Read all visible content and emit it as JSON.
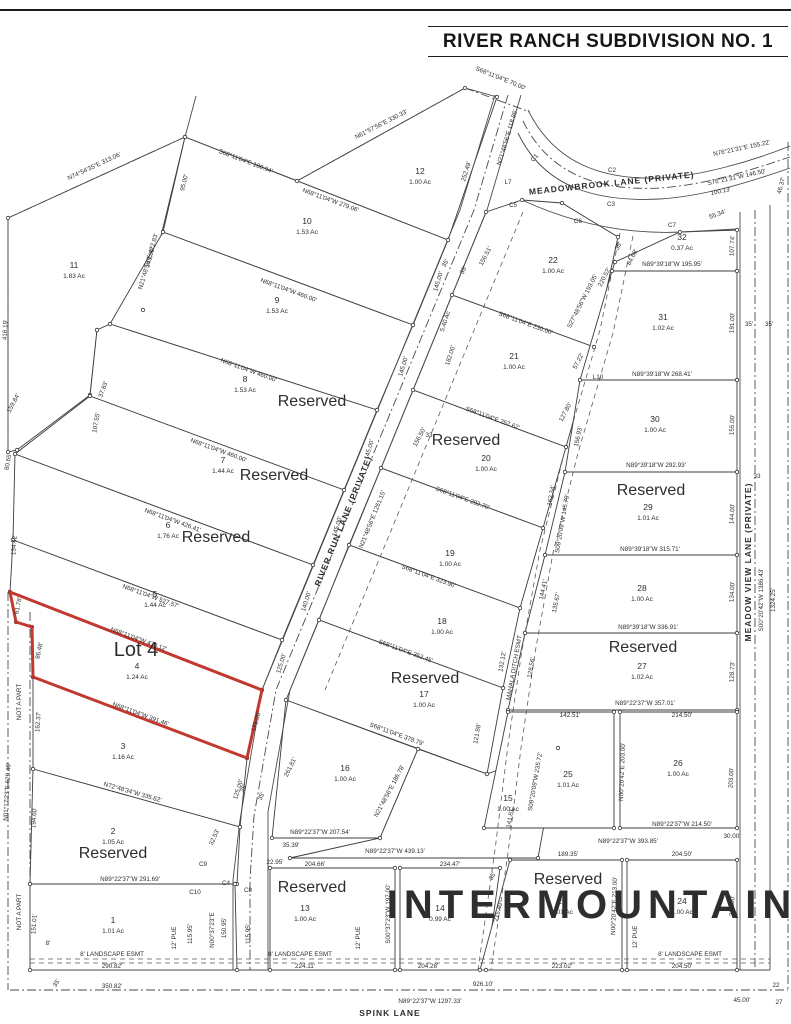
{
  "title": "RIVER RANCH SUBDIVISION NO. 1",
  "watermark": "INTERMOUNTAIN",
  "colors": {
    "highlight_red": "#c2382e",
    "reserved_blue": "#1a607f",
    "line": "#3c3c3c",
    "watermark": "rgba(125,125,125,0.22)"
  },
  "highlight": {
    "label": "Lot 4",
    "x": 136,
    "y": 656,
    "lot": "4"
  },
  "streets": [
    {
      "name": "MEADOWBROOK  LANE  (PRIVATE)",
      "x": 612,
      "y": 186,
      "r": -6,
      "fs": 8.5
    },
    {
      "name": "RIVER RUN LANE (PRIVATE)",
      "x": 346,
      "y": 522,
      "r": -68,
      "fs": 8.5
    },
    {
      "name": "MEADOW VIEW LANE (PRIVATE)",
      "x": 751,
      "y": 562,
      "r": -90,
      "fs": 8.5
    },
    {
      "name": "SPINK LANE",
      "x": 390,
      "y": 1016,
      "r": 0,
      "fs": 8.5
    }
  ],
  "lots": [
    {
      "num": "11",
      "ac": "1.83 Ac",
      "pts": "8,218 185,137 143,310 97,330 90,395 17,450 8,452",
      "lx": 74,
      "ly": 268
    },
    {
      "num": "12",
      "ac": "1.00 Ac",
      "pts": "185,137 297,181 465,88 497,97 448,240",
      "lx": 420,
      "ly": 174
    },
    {
      "num": "10",
      "ac": "1.53 Ac",
      "pts": "185,137 448,240 413,325 163,232",
      "lx": 307,
      "ly": 224
    },
    {
      "num": "9",
      "ac": "1.53 Ac",
      "pts": "163,232 413,325 377,410 110,324",
      "lx": 277,
      "ly": 303
    },
    {
      "num": "8",
      "ac": "1.53 Ac",
      "pts": "110,324 377,410 344,490 90,396 97,330",
      "lx": 245,
      "ly": 382,
      "res": true,
      "rx": 312,
      "ry": 406
    },
    {
      "num": "7",
      "ac": "1.44 Ac",
      "pts": "90,396 344,490 313,565 15,454",
      "lx": 223,
      "ly": 463,
      "res": true,
      "rx": 274,
      "ry": 480
    },
    {
      "num": "6",
      "ac": "1.76 Ac",
      "pts": "15,454 313,565 282,640 13,540",
      "lx": 168,
      "ly": 528,
      "res": true,
      "rx": 216,
      "ry": 542
    },
    {
      "num": "5",
      "ac": "1.44 Ac",
      "pts": "13,540 282,640 262,690 10,592",
      "lx": 155,
      "ly": 597
    },
    {
      "num": "4",
      "ac": "1.24 Ac",
      "pts": "10,592 262,690 247,758 33,677 32,627 16,622",
      "lx": 137,
      "ly": 669,
      "hl": true
    },
    {
      "num": "3",
      "ac": "1.16 Ac",
      "pts": "33,677 247,758 240,827 33,769",
      "lx": 123,
      "ly": 749
    },
    {
      "num": "2",
      "ac": "1.05 Ac",
      "pts": "33,769 240,827 237,884 30,884",
      "lx": 113,
      "ly": 834,
      "res": true,
      "rx": 113,
      "ry": 858
    },
    {
      "num": "1",
      "ac": "1.01 Ac",
      "pts": "30,884 235,884 237,970 30,970",
      "lx": 113,
      "ly": 923
    },
    {
      "num": "22",
      "ac": "1.00 Ac",
      "pts": "452,295 486,212 522,200 562,203 618,237 594,347",
      "lx": 553,
      "ly": 263
    },
    {
      "num": "21",
      "ac": "1.00 Ac",
      "pts": "413,390 452,295 594,347 566,447",
      "lx": 514,
      "ly": 359
    },
    {
      "num": "20",
      "ac": "1.00 Ac",
      "pts": "381,468 413,390 566,447 543,528",
      "lx": 486,
      "ly": 461,
      "res": true,
      "rx": 466,
      "ry": 445
    },
    {
      "num": "19",
      "ac": "1.00 Ac",
      "pts": "349,545 381,468 543,528 520,608",
      "lx": 450,
      "ly": 556
    },
    {
      "num": "18",
      "ac": "1.00 Ac",
      "pts": "319,620 349,545 520,608 503,688",
      "lx": 442,
      "ly": 624
    },
    {
      "num": "17",
      "ac": "1.00 Ac",
      "pts": "286,700 319,620 503,688 487,774",
      "lx": 424,
      "ly": 697,
      "res": true,
      "rx": 425,
      "ry": 683
    },
    {
      "num": "16",
      "ac": "1.00 Ac",
      "pts": "286,700 418,749 380,838 272,838",
      "lx": 345,
      "ly": 771
    },
    {
      "num": "15",
      "ac": "1.00 Ac",
      "pts": "418,749 487,774 558,748 538,858 290,858 380,838",
      "lx": 508,
      "ly": 801
    },
    {
      "num": "13",
      "ac": "1.00 Ac",
      "pts": "270,868 395,868 395,970 270,970",
      "lx": 305,
      "ly": 911,
      "res": true,
      "rx": 312,
      "ry": 892
    },
    {
      "num": "14",
      "ac": "0.99 Ac",
      "pts": "400,868 500,868 486,970 400,970",
      "lx": 440,
      "ly": 911
    },
    {
      "num": "23",
      "ac": "1.01 Ac",
      "pts": "510,860 622,860 622,970 480,970",
      "lx": 562,
      "ly": 904,
      "res": true,
      "rx": 568,
      "ry": 884
    },
    {
      "num": "24",
      "ac": "1.00 Ac",
      "pts": "627,860 737,860 737,970 627,970",
      "lx": 682,
      "ly": 904
    },
    {
      "num": "32",
      "ac": "0.37 Ac",
      "pts": "612,271 737,271 737,230 680,232 615,262",
      "lx": 682,
      "ly": 240
    },
    {
      "num": "31",
      "ac": "1.02 Ac",
      "pts": "612,271 737,271 737,380 580,380",
      "lx": 663,
      "ly": 320
    },
    {
      "num": "30",
      "ac": "1.00 Ac",
      "pts": "580,380 737,380 737,472 565,472",
      "lx": 655,
      "ly": 422
    },
    {
      "num": "29",
      "ac": "1.01 Ac",
      "pts": "565,472 737,472 737,555 545,555",
      "lx": 648,
      "ly": 510,
      "res": true,
      "rx": 651,
      "ry": 495
    },
    {
      "num": "28",
      "ac": "1.00 Ac",
      "pts": "545,555 737,555 737,633 525,633",
      "lx": 642,
      "ly": 591
    },
    {
      "num": "27",
      "ac": "1.02 Ac",
      "pts": "525,633 737,633 737,710 508,710",
      "lx": 642,
      "ly": 669,
      "res": true,
      "rx": 643,
      "ry": 652
    },
    {
      "num": "26",
      "ac": "1.00 Ac",
      "pts": "620,712 737,712 737,828 620,828",
      "lx": 678,
      "ly": 766
    },
    {
      "num": "25",
      "ac": "1.01 Ac",
      "pts": "508,712 614,712 614,828 484,828",
      "lx": 568,
      "ly": 777
    }
  ],
  "reserved_label": "Reserved",
  "bearings": [
    {
      "t": "N74°54'35\"E  313.06'",
      "x": 95,
      "y": 168,
      "r": -25
    },
    {
      "t": "S68°11'04\"E  180.94'",
      "x": 245,
      "y": 163,
      "r": 21
    },
    {
      "t": "N61°57'56\"E  330.33'",
      "x": 382,
      "y": 126,
      "r": -27
    },
    {
      "t": "S68°11'04\"E  70.00'",
      "x": 500,
      "y": 80,
      "r": 22
    },
    {
      "t": "N21°48'56\"E 118.86'",
      "x": 509,
      "y": 138,
      "r": -73
    },
    {
      "t": "252.49'",
      "x": 468,
      "y": 172,
      "r": -73
    },
    {
      "t": "95.00'",
      "x": 186,
      "y": 183,
      "r": -76
    },
    {
      "t": "N21°48'56\"E  422.83'",
      "x": 150,
      "y": 262,
      "r": -74
    },
    {
      "t": "145.00'",
      "x": 152,
      "y": 258,
      "r": -74
    },
    {
      "t": "416.19'",
      "x": 7,
      "y": 330,
      "r": -88
    },
    {
      "t": "107.55'",
      "x": 98,
      "y": 423,
      "r": -80
    },
    {
      "t": "37.83'",
      "x": 105,
      "y": 390,
      "r": -70
    },
    {
      "t": "159.84'",
      "x": 15,
      "y": 404,
      "r": -62
    },
    {
      "t": "80.65'",
      "x": 10,
      "y": 462,
      "r": -80
    },
    {
      "t": "134.42'",
      "x": 16,
      "y": 545,
      "r": -86
    },
    {
      "t": "61.78'",
      "x": 20,
      "y": 606,
      "r": -78
    },
    {
      "t": "86.48'",
      "x": 41,
      "y": 651,
      "r": -78
    },
    {
      "t": "162.37'",
      "x": 40,
      "y": 722,
      "r": -86
    },
    {
      "t": "NOT A PART",
      "x": 21,
      "y": 702,
      "r": -90
    },
    {
      "t": "NOT A PART",
      "x": 21,
      "y": 912,
      "r": -90
    },
    {
      "t": "N01°17'23\"E  629.46'",
      "x": 9,
      "y": 792,
      "r": -87
    },
    {
      "t": "194.60'",
      "x": 36,
      "y": 818,
      "r": -86
    },
    {
      "t": "151.01'",
      "x": 36,
      "y": 924,
      "r": -86
    },
    {
      "t": "N68°11'04\"W  279.06'",
      "x": 330,
      "y": 202,
      "r": 20
    },
    {
      "t": "N68°11'04\"W  460.00'",
      "x": 288,
      "y": 292,
      "r": 20
    },
    {
      "t": "N68°11'04\"W  460.00'",
      "x": 248,
      "y": 372,
      "r": 20
    },
    {
      "t": "N68°11'04\"W  460.00'",
      "x": 218,
      "y": 452,
      "r": 20
    },
    {
      "t": "N68°11'04\"W  426.41'",
      "x": 172,
      "y": 522,
      "r": 20
    },
    {
      "t": "N68°11'04\"W  527.57'",
      "x": 150,
      "y": 598,
      "r": 20
    },
    {
      "t": "N68°11'04\"W  478.12'",
      "x": 138,
      "y": 641,
      "r": 20
    },
    {
      "t": "N68°11'04\"W  391.46'",
      "x": 140,
      "y": 716,
      "r": 20
    },
    {
      "t": "N72°48'34\"W  335.62'",
      "x": 132,
      "y": 794,
      "r": 16
    },
    {
      "t": "N89°22'37\"W  291.69'",
      "x": 130,
      "y": 881,
      "r": 0
    },
    {
      "t": "145.00'",
      "x": 440,
      "y": 282,
      "r": -73
    },
    {
      "t": "145.00'",
      "x": 405,
      "y": 367,
      "r": -73
    },
    {
      "t": "145.00'",
      "x": 371,
      "y": 450,
      "r": -73
    },
    {
      "t": "145.00'",
      "x": 339,
      "y": 527,
      "r": -73
    },
    {
      "t": "140.00'",
      "x": 308,
      "y": 602,
      "r": -73
    },
    {
      "t": "125.00'",
      "x": 283,
      "y": 664,
      "r": -73
    },
    {
      "t": "175.00'",
      "x": 258,
      "y": 722,
      "r": -73
    },
    {
      "t": "125.00'",
      "x": 240,
      "y": 790,
      "r": -73
    },
    {
      "t": "32.53'",
      "x": 216,
      "y": 838,
      "r": -66
    },
    {
      "t": "35'",
      "x": 245,
      "y": 789,
      "r": -64
    },
    {
      "t": "35'",
      "x": 263,
      "y": 797,
      "r": -64
    },
    {
      "t": "C9",
      "x": 203,
      "y": 866,
      "r": 0
    },
    {
      "t": "C10",
      "x": 195,
      "y": 894,
      "r": 0
    },
    {
      "t": "C4",
      "x": 226,
      "y": 885,
      "r": 0
    },
    {
      "t": "C8",
      "x": 248,
      "y": 892,
      "r": 0
    },
    {
      "t": "N00°37'23\"E",
      "x": 214,
      "y": 930,
      "r": -90
    },
    {
      "t": "150.95'",
      "x": 226,
      "y": 928,
      "r": -90
    },
    {
      "t": "12' PUE",
      "x": 176,
      "y": 938,
      "r": -90
    },
    {
      "t": "115.95'",
      "x": 192,
      "y": 934,
      "r": -90
    },
    {
      "t": "8'",
      "x": 48,
      "y": 945,
      "r": 0
    },
    {
      "t": "8' LANDSCAPE ESMT",
      "x": 112,
      "y": 956,
      "r": 0
    },
    {
      "t": "290.82'",
      "x": 112,
      "y": 968,
      "r": 0
    },
    {
      "t": "35'",
      "x": 58,
      "y": 984,
      "r": -60
    },
    {
      "t": "350.82'",
      "x": 112,
      "y": 988,
      "r": 0
    },
    {
      "t": "926.10'",
      "x": 483,
      "y": 986,
      "r": 0
    },
    {
      "t": "N89°22'37\"W  1297.33'",
      "x": 430,
      "y": 1003,
      "r": 0
    },
    {
      "t": "45.00'",
      "x": 742,
      "y": 1002,
      "r": 0
    },
    {
      "t": "22",
      "x": 776,
      "y": 987,
      "r": 0
    },
    {
      "t": "27",
      "x": 779,
      "y": 1004,
      "r": 0
    },
    {
      "t": "S68°11'04\"E  230.00'",
      "x": 525,
      "y": 325,
      "r": 20
    },
    {
      "t": "S68°11'04\"E  257.62'",
      "x": 492,
      "y": 420,
      "r": 20
    },
    {
      "t": "S68°11'04\"E  292.70'",
      "x": 462,
      "y": 500,
      "r": 20
    },
    {
      "t": "S68°11'04\"E  323.90'",
      "x": 428,
      "y": 578,
      "r": 20
    },
    {
      "t": "S68°11'04\"E  352.45'",
      "x": 405,
      "y": 653,
      "r": 20
    },
    {
      "t": "S68°11'04\"E  378.79'",
      "x": 396,
      "y": 736,
      "r": 20
    },
    {
      "t": "N21°48'56\"E  186.78'",
      "x": 391,
      "y": 792,
      "r": -62
    },
    {
      "t": "N89°22'37\"W  207.54'",
      "x": 320,
      "y": 834,
      "r": 0
    },
    {
      "t": "N89°22'37\"W  439.13'",
      "x": 395,
      "y": 853,
      "r": 0
    },
    {
      "t": "204.66'",
      "x": 315,
      "y": 866,
      "r": 0
    },
    {
      "t": "234.47'",
      "x": 450,
      "y": 866,
      "r": 0
    },
    {
      "t": "35.39'",
      "x": 291,
      "y": 847,
      "r": 0
    },
    {
      "t": "22.95'",
      "x": 275,
      "y": 864,
      "r": 0
    },
    {
      "t": "S00°37'23\"W  197.00'",
      "x": 390,
      "y": 914,
      "r": -90
    },
    {
      "t": "12' PUE",
      "x": 360,
      "y": 938,
      "r": -90
    },
    {
      "t": "115.95'",
      "x": 250,
      "y": 934,
      "r": -90
    },
    {
      "t": "12' PUE",
      "x": 637,
      "y": 937,
      "r": -90
    },
    {
      "t": "8' LANDSCAPE ESMT",
      "x": 300,
      "y": 956,
      "r": 0
    },
    {
      "t": "8' LANDSCAPE ESMT",
      "x": 690,
      "y": 956,
      "r": 0
    },
    {
      "t": "224.11'",
      "x": 305,
      "y": 968,
      "r": 0
    },
    {
      "t": "204.28'",
      "x": 428,
      "y": 968,
      "r": 0
    },
    {
      "t": "223.02'",
      "x": 562,
      "y": 968,
      "r": 0
    },
    {
      "t": "204.50'",
      "x": 682,
      "y": 968,
      "r": 0
    },
    {
      "t": "261.81'",
      "x": 292,
      "y": 768,
      "r": -64
    },
    {
      "t": "5.40 Ac",
      "x": 447,
      "y": 322,
      "r": -72
    },
    {
      "t": "182.00'",
      "x": 452,
      "y": 356,
      "r": -72
    },
    {
      "t": "N21°48'56\"E  1261.15'",
      "x": 374,
      "y": 520,
      "r": -68
    },
    {
      "t": "35'",
      "x": 447,
      "y": 264,
      "r": -62
    },
    {
      "t": "35'",
      "x": 465,
      "y": 271,
      "r": -62
    },
    {
      "t": "35'",
      "x": 620,
      "y": 247,
      "r": -62
    },
    {
      "t": "33",
      "x": 429,
      "y": 437,
      "r": 0
    },
    {
      "t": "156.51'",
      "x": 487,
      "y": 257,
      "r": -62
    },
    {
      "t": "S27°48'56\"W  193.05'",
      "x": 584,
      "y": 302,
      "r": -63
    },
    {
      "t": "220.52'",
      "x": 606,
      "y": 278,
      "r": -63
    },
    {
      "t": "57.22'",
      "x": 580,
      "y": 362,
      "r": -63
    },
    {
      "t": "L10",
      "x": 598,
      "y": 379,
      "r": 0
    },
    {
      "t": "156.50'",
      "x": 421,
      "y": 438,
      "r": -62
    },
    {
      "t": "127.80'",
      "x": 567,
      "y": 413,
      "r": -62
    },
    {
      "t": "156.93'",
      "x": 580,
      "y": 437,
      "r": -78
    },
    {
      "t": "162.34'",
      "x": 553,
      "y": 496,
      "r": -80
    },
    {
      "t": "S09°20'09\"W 145.79'",
      "x": 564,
      "y": 524,
      "r": -80
    },
    {
      "t": "144.41'",
      "x": 545,
      "y": 590,
      "r": -78
    },
    {
      "t": "135.67'",
      "x": 558,
      "y": 603,
      "r": -78
    },
    {
      "t": "MAHALA  DITCH  ESMT",
      "x": 516,
      "y": 668,
      "r": -80
    },
    {
      "t": "132.12'",
      "x": 504,
      "y": 662,
      "r": -80
    },
    {
      "t": "128.56'",
      "x": 533,
      "y": 668,
      "r": -80
    },
    {
      "t": "121.88'",
      "x": 479,
      "y": 734,
      "r": -80
    },
    {
      "t": "S09°20'09\"W 235.72'",
      "x": 537,
      "y": 782,
      "r": -80
    },
    {
      "t": "141.81'",
      "x": 512,
      "y": 818,
      "r": -80
    },
    {
      "t": "35'",
      "x": 494,
      "y": 877,
      "r": -62
    },
    {
      "t": "215.49'",
      "x": 500,
      "y": 912,
      "r": -75
    },
    {
      "t": "142.51'",
      "x": 570,
      "y": 717,
      "r": 0
    },
    {
      "t": "214.50'",
      "x": 682,
      "y": 717,
      "r": 0
    },
    {
      "t": "N89°39'18\"W  195.95'",
      "x": 672,
      "y": 266,
      "r": 0
    },
    {
      "t": "N89°39'18\"W  268.41'",
      "x": 662,
      "y": 376,
      "r": 0
    },
    {
      "t": "N89°39'18\"W  292.93'",
      "x": 656,
      "y": 467,
      "r": 0
    },
    {
      "t": "N89°39'18\"W  315.71'",
      "x": 650,
      "y": 551,
      "r": 0
    },
    {
      "t": "N89°39'18\"W  336.91'",
      "x": 648,
      "y": 629,
      "r": 0
    },
    {
      "t": "N89°22'37\"W  357.01'",
      "x": 645,
      "y": 705,
      "r": 0
    },
    {
      "t": "N89°22'37\"W  214.50'",
      "x": 682,
      "y": 826,
      "r": 0
    },
    {
      "t": "N89°22'37\"W  393.85'",
      "x": 628,
      "y": 843,
      "r": 0
    },
    {
      "t": "30.00'",
      "x": 732,
      "y": 838,
      "r": 0
    },
    {
      "t": "189.35'",
      "x": 568,
      "y": 856,
      "r": 0
    },
    {
      "t": "204.50'",
      "x": 682,
      "y": 856,
      "r": 0
    },
    {
      "t": "107.74'",
      "x": 734,
      "y": 246,
      "r": -87
    },
    {
      "t": "191.00'",
      "x": 734,
      "y": 323,
      "r": -87
    },
    {
      "t": "155.00'",
      "x": 734,
      "y": 425,
      "r": -87
    },
    {
      "t": "144.00'",
      "x": 734,
      "y": 514,
      "r": -87
    },
    {
      "t": "134.00'",
      "x": 734,
      "y": 592,
      "r": -87
    },
    {
      "t": "128.73'",
      "x": 734,
      "y": 672,
      "r": -87
    },
    {
      "t": "203.00'",
      "x": 733,
      "y": 778,
      "r": -87
    },
    {
      "t": "213.00'",
      "x": 734,
      "y": 906,
      "r": -87
    },
    {
      "t": "N00°20'42\"E  203.00'",
      "x": 624,
      "y": 772,
      "r": -88
    },
    {
      "t": "N00°20'42\"E  213.00'",
      "x": 616,
      "y": 906,
      "r": -88
    },
    {
      "t": "84.68'",
      "x": 634,
      "y": 258,
      "r": -63
    },
    {
      "t": "55.34'",
      "x": 718,
      "y": 216,
      "r": -20
    },
    {
      "t": "35'",
      "x": 749,
      "y": 326,
      "r": 0
    },
    {
      "t": "35'",
      "x": 769,
      "y": 326,
      "r": 0
    },
    {
      "t": "33",
      "x": 757,
      "y": 478,
      "r": 0
    },
    {
      "t": "N76°21'31\"E  155.22'",
      "x": 742,
      "y": 150,
      "r": -12
    },
    {
      "t": "S76°21'31\"W  146.50'",
      "x": 737,
      "y": 179,
      "r": -12
    },
    {
      "t": "100.13'",
      "x": 721,
      "y": 193,
      "r": -12
    },
    {
      "t": "46.37'",
      "x": 783,
      "y": 186,
      "r": -75
    },
    {
      "t": "C1",
      "x": 536,
      "y": 159,
      "r": -50
    },
    {
      "t": "C2",
      "x": 612,
      "y": 172,
      "r": 0
    },
    {
      "t": "C3",
      "x": 611,
      "y": 206,
      "r": 0
    },
    {
      "t": "C5",
      "x": 513,
      "y": 207,
      "r": 0
    },
    {
      "t": "C6",
      "x": 578,
      "y": 223,
      "r": 0
    },
    {
      "t": "C7",
      "x": 672,
      "y": 227,
      "r": 0
    },
    {
      "t": "L7",
      "x": 508,
      "y": 184,
      "r": 0
    },
    {
      "t": "S00°20'42\"W  1386.43'",
      "x": 763,
      "y": 600,
      "r": -90
    },
    {
      "t": "1324.25'",
      "x": 775,
      "y": 600,
      "r": -90
    }
  ]
}
